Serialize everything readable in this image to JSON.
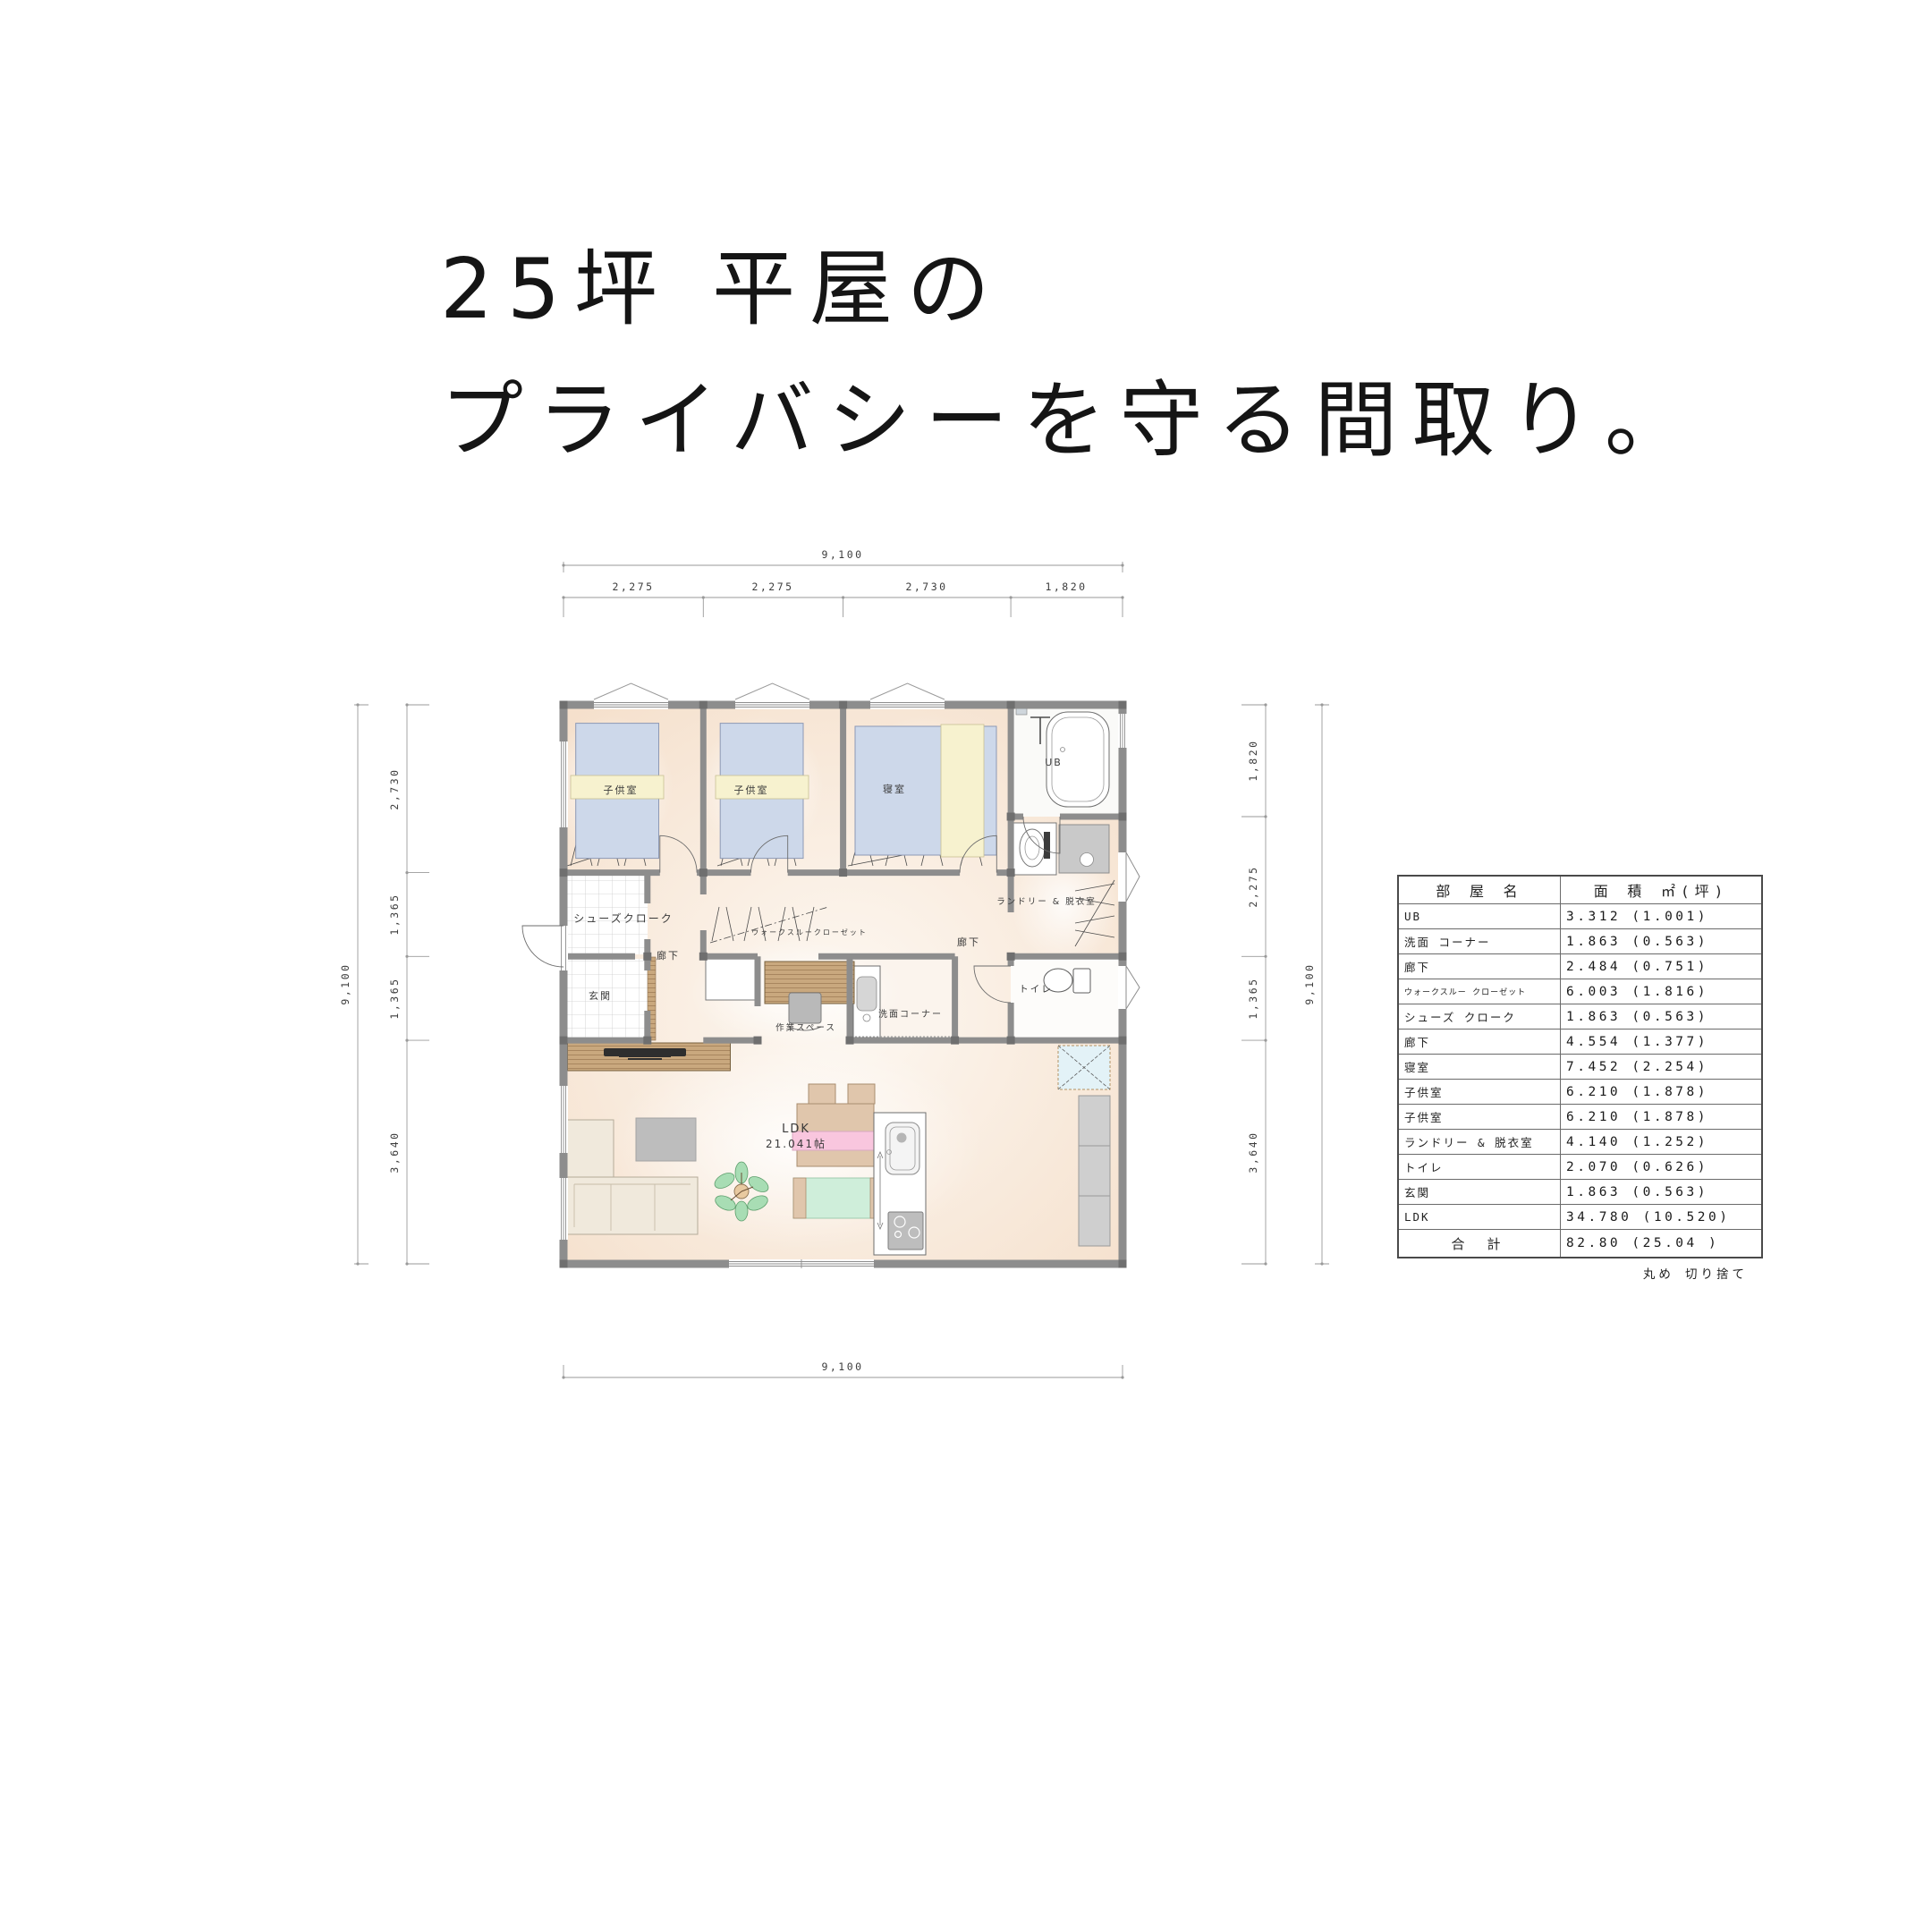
{
  "title": {
    "line1": "25坪 平屋の",
    "line2": "プライバシーを守る間取り。"
  },
  "plan": {
    "rooms": {
      "child1": "子供室",
      "child2": "子供室",
      "bedroom": "寝室",
      "ub": "UB",
      "laundry": "ランドリー & 脱衣室",
      "corridor_right": "廊下",
      "corridor_left": "廊下",
      "shoes": "シューズクローク",
      "wtc": "ウォークスルークローゼット",
      "entrance": "玄関",
      "workspace": "作業スペース",
      "wash": "洗面コーナー",
      "toilet": "トイレ",
      "ldk1": "LDK",
      "ldk2": "21.041帖"
    },
    "dims": {
      "top_total": "9,100",
      "top_segments": [
        "2,275",
        "2,275",
        "2,730",
        "1,820"
      ],
      "left_total": "9,100",
      "left_segments": [
        "2,730",
        "1,365",
        "1,365",
        "3,640"
      ],
      "right_total": "9,100",
      "right_segments": [
        "1,820",
        "2,275",
        "1,365",
        "3,640"
      ],
      "bottom_total": "9,100"
    }
  },
  "table": {
    "headers": {
      "room": "部 屋 名",
      "area": "面 積 ㎡(坪)"
    },
    "rows": [
      {
        "name": "UB",
        "area": "3.312 (1.001)"
      },
      {
        "name": "洗面 コーナー",
        "area": "1.863 (0.563)"
      },
      {
        "name": "廊下",
        "area": "2.484 (0.751)"
      },
      {
        "name": "ウォークスルー クローゼット",
        "area": "6.003 (1.816)"
      },
      {
        "name": "シューズ クローク",
        "area": "1.863 (0.563)"
      },
      {
        "name": "廊下",
        "area": "4.554 (1.377)"
      },
      {
        "name": "寝室",
        "area": "7.452 (2.254)"
      },
      {
        "name": "子供室",
        "area": "6.210 (1.878)"
      },
      {
        "name": "子供室",
        "area": "6.210 (1.878)"
      },
      {
        "name": "ランドリー & 脱衣室",
        "area": "4.140 (1.252)"
      },
      {
        "name": "トイレ",
        "area": "2.070 (0.626)"
      },
      {
        "name": "玄関",
        "area": "1.863 (0.563)"
      },
      {
        "name": "LDK",
        "area": "34.780 (10.520)"
      }
    ],
    "total": {
      "name": "合 計",
      "area": "82.80 (25.04 )"
    },
    "note": "丸め 切り捨て"
  },
  "colors": {
    "wall": "#8d8d8d",
    "floor_edge": "#f5e0cc",
    "floor_center": "#fdf8f2",
    "bed": "#cdd8ea",
    "pillow": "#f7f2cf",
    "wood": "#c9a87e",
    "table_pink": "#f9c6de",
    "rug_green": "#cfeeda",
    "fridge_aqua": "#e3f2f7",
    "furniture_gray": "#bdbdbd"
  }
}
